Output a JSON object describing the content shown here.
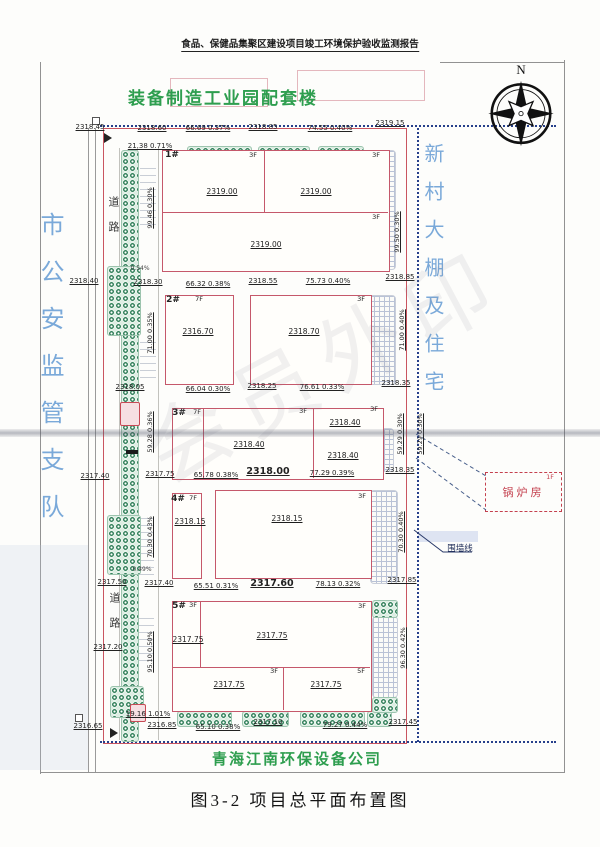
{
  "header": {
    "title": "食品、保健品集聚区建设项目竣工环境保护验收监测报告"
  },
  "figure": {
    "caption": "图3-2 项目总平面布置图"
  },
  "compass": {
    "n": "N"
  },
  "site": {
    "top_company": "装备制造工业园配套楼",
    "bottom_company": "青海江南环保设备公司",
    "west_neighbor": "市公安监管支队",
    "east_neighbor": "新村大棚及住宅",
    "road": "道路",
    "boiler": {
      "name": "锅炉房",
      "floor": "1F"
    },
    "wall_line": "围墙线"
  },
  "colors": {
    "boundary_red": "#c95560",
    "fence_blue": "#27408b",
    "company_green": "#2e9e4f",
    "neighbor_blue": "#7aa9d9",
    "boiler_red": "#c4404e"
  },
  "plan_labels": [
    {
      "t": "2318.45",
      "x": 90,
      "y": 124,
      "c": "elev"
    },
    {
      "t": "2318.60",
      "x": 152,
      "y": 125,
      "c": "elev"
    },
    {
      "t": "66.69 0.37%",
      "x": 208,
      "y": 125,
      "c": "slope"
    },
    {
      "t": "2318.85",
      "x": 263,
      "y": 124,
      "c": "elev"
    },
    {
      "t": "74.55 0.40%",
      "x": 330,
      "y": 125,
      "c": "slope"
    },
    {
      "t": "2319.15",
      "x": 390,
      "y": 120,
      "c": "elev"
    },
    {
      "t": "21.38 0.71%",
      "x": 150,
      "y": 143,
      "c": "slope"
    },
    {
      "t": "2318.40",
      "x": 84,
      "y": 278,
      "c": "elev"
    },
    {
      "t": "2318.30",
      "x": 148,
      "y": 279,
      "c": "elev"
    },
    {
      "t": "66.32 0.38%",
      "x": 208,
      "y": 281,
      "c": "slope"
    },
    {
      "t": "2318.55",
      "x": 263,
      "y": 278,
      "c": "elev"
    },
    {
      "t": "75.73 0.40%",
      "x": 328,
      "y": 278,
      "c": "slope"
    },
    {
      "t": "2318.85",
      "x": 400,
      "y": 274,
      "c": "elev"
    },
    {
      "t": "2318.05",
      "x": 130,
      "y": 384,
      "c": "elev"
    },
    {
      "t": "66.04 0.30%",
      "x": 208,
      "y": 386,
      "c": "slope"
    },
    {
      "t": "2318.25",
      "x": 262,
      "y": 383,
      "c": "elev"
    },
    {
      "t": "76.61 0.33%",
      "x": 322,
      "y": 384,
      "c": "slope"
    },
    {
      "t": "2318.35",
      "x": 396,
      "y": 380,
      "c": "elev"
    },
    {
      "t": "2317.40",
      "x": 95,
      "y": 473,
      "c": "elev"
    },
    {
      "t": "2317.75",
      "x": 160,
      "y": 471,
      "c": "elev"
    },
    {
      "t": "65.78 0.38%",
      "x": 216,
      "y": 472,
      "c": "slope"
    },
    {
      "t": "2318.00",
      "x": 268,
      "y": 467,
      "c": "elev-lg"
    },
    {
      "t": "77.29 0.39%",
      "x": 332,
      "y": 470,
      "c": "slope"
    },
    {
      "t": "2318.35",
      "x": 400,
      "y": 467,
      "c": "elev"
    },
    {
      "t": "2317.50",
      "x": 112,
      "y": 579,
      "c": "elev"
    },
    {
      "t": "2317.40",
      "x": 159,
      "y": 580,
      "c": "elev"
    },
    {
      "t": "65.51 0.31%",
      "x": 216,
      "y": 583,
      "c": "slope"
    },
    {
      "t": "2317.60",
      "x": 272,
      "y": 579,
      "c": "elev-lg"
    },
    {
      "t": "78.13 0.32%",
      "x": 338,
      "y": 581,
      "c": "slope"
    },
    {
      "t": "2317.85",
      "x": 402,
      "y": 577,
      "c": "elev"
    },
    {
      "t": "19.16 1.01%",
      "x": 148,
      "y": 711,
      "c": "slope"
    },
    {
      "t": "2316.65",
      "x": 88,
      "y": 723,
      "c": "elev"
    },
    {
      "t": "2316.85",
      "x": 162,
      "y": 722,
      "c": "elev"
    },
    {
      "t": "65.10 0.38%",
      "x": 218,
      "y": 724,
      "c": "slope"
    },
    {
      "t": "2317.10",
      "x": 268,
      "y": 719,
      "c": "elev"
    },
    {
      "t": "79.27 0.44%",
      "x": 345,
      "y": 722,
      "c": "slope"
    },
    {
      "t": "2317.45",
      "x": 403,
      "y": 719,
      "c": "elev"
    },
    {
      "t": "2317.20",
      "x": 108,
      "y": 644,
      "c": "elev"
    },
    {
      "t": "0.54%",
      "x": 140,
      "y": 266,
      "c": "tiny"
    },
    {
      "t": "0.49%",
      "x": 142,
      "y": 567,
      "c": "tiny"
    },
    {
      "t": "1#",
      "x": 172,
      "y": 151,
      "c": "bid"
    },
    {
      "t": "3F",
      "x": 253,
      "y": 152,
      "c": "floor"
    },
    {
      "t": "3F",
      "x": 376,
      "y": 152,
      "c": "floor"
    },
    {
      "t": "3F",
      "x": 376,
      "y": 214,
      "c": "floor"
    },
    {
      "t": "2319.00",
      "x": 222,
      "y": 188,
      "c": "belev"
    },
    {
      "t": "2319.00",
      "x": 316,
      "y": 188,
      "c": "belev"
    },
    {
      "t": "2319.00",
      "x": 266,
      "y": 241,
      "c": "belev"
    },
    {
      "t": "2#",
      "x": 173,
      "y": 296,
      "c": "bid"
    },
    {
      "t": "7F",
      "x": 199,
      "y": 296,
      "c": "floor"
    },
    {
      "t": "2316.70",
      "x": 198,
      "y": 328,
      "c": "belev"
    },
    {
      "t": "3F",
      "x": 361,
      "y": 296,
      "c": "floor"
    },
    {
      "t": "2318.70",
      "x": 304,
      "y": 328,
      "c": "belev"
    },
    {
      "t": "3#",
      "x": 179,
      "y": 409,
      "c": "bid"
    },
    {
      "t": "7F",
      "x": 197,
      "y": 409,
      "c": "floor"
    },
    {
      "t": "3F",
      "x": 303,
      "y": 408,
      "c": "floor"
    },
    {
      "t": "3F",
      "x": 374,
      "y": 406,
      "c": "floor"
    },
    {
      "t": "2318.40",
      "x": 249,
      "y": 441,
      "c": "belev"
    },
    {
      "t": "2318.40",
      "x": 345,
      "y": 419,
      "c": "belev"
    },
    {
      "t": "2318.40",
      "x": 343,
      "y": 452,
      "c": "belev"
    },
    {
      "t": "4#",
      "x": 178,
      "y": 495,
      "c": "bid"
    },
    {
      "t": "7F",
      "x": 193,
      "y": 495,
      "c": "floor"
    },
    {
      "t": "2318.15",
      "x": 190,
      "y": 518,
      "c": "belev"
    },
    {
      "t": "2318.15",
      "x": 287,
      "y": 515,
      "c": "belev"
    },
    {
      "t": "3F",
      "x": 362,
      "y": 493,
      "c": "floor"
    },
    {
      "t": "5#",
      "x": 179,
      "y": 602,
      "c": "bid"
    },
    {
      "t": "3F",
      "x": 193,
      "y": 602,
      "c": "floor"
    },
    {
      "t": "3F",
      "x": 362,
      "y": 603,
      "c": "floor"
    },
    {
      "t": "2317.75",
      "x": 272,
      "y": 632,
      "c": "belev"
    },
    {
      "t": "2317.75",
      "x": 188,
      "y": 636,
      "c": "belev"
    },
    {
      "t": "3F",
      "x": 274,
      "y": 668,
      "c": "floor"
    },
    {
      "t": "2317.75",
      "x": 229,
      "y": 681,
      "c": "belev"
    },
    {
      "t": "5F",
      "x": 361,
      "y": 668,
      "c": "floor"
    },
    {
      "t": "2317.75",
      "x": 326,
      "y": 681,
      "c": "belev"
    },
    {
      "t": "1F",
      "x": 550,
      "y": 474,
      "c": "floor-red"
    },
    {
      "t": "围墙线",
      "x": 460,
      "y": 545,
      "c": "wall"
    }
  ],
  "plan_vlabels": [
    {
      "t": "99.46 0.30%",
      "x": 150,
      "y": 208
    },
    {
      "t": "99.50 0.30%",
      "x": 397,
      "y": 232
    },
    {
      "t": "71.00 0.35%",
      "x": 150,
      "y": 333
    },
    {
      "t": "71.00 0.40%",
      "x": 402,
      "y": 330
    },
    {
      "t": "59.28 0.36%",
      "x": 150,
      "y": 432
    },
    {
      "t": "59.29 0.30%",
      "x": 400,
      "y": 434
    },
    {
      "t": "59.29 0.30%",
      "x": 420,
      "y": 434
    },
    {
      "t": "70.30 0.43%",
      "x": 150,
      "y": 537
    },
    {
      "t": "70.30 0.40%",
      "x": 401,
      "y": 532
    },
    {
      "t": "95.10 0.50%",
      "x": 150,
      "y": 652
    },
    {
      "t": "96.30 0.42%",
      "x": 403,
      "y": 648
    }
  ],
  "watermark_text": "会员外印"
}
